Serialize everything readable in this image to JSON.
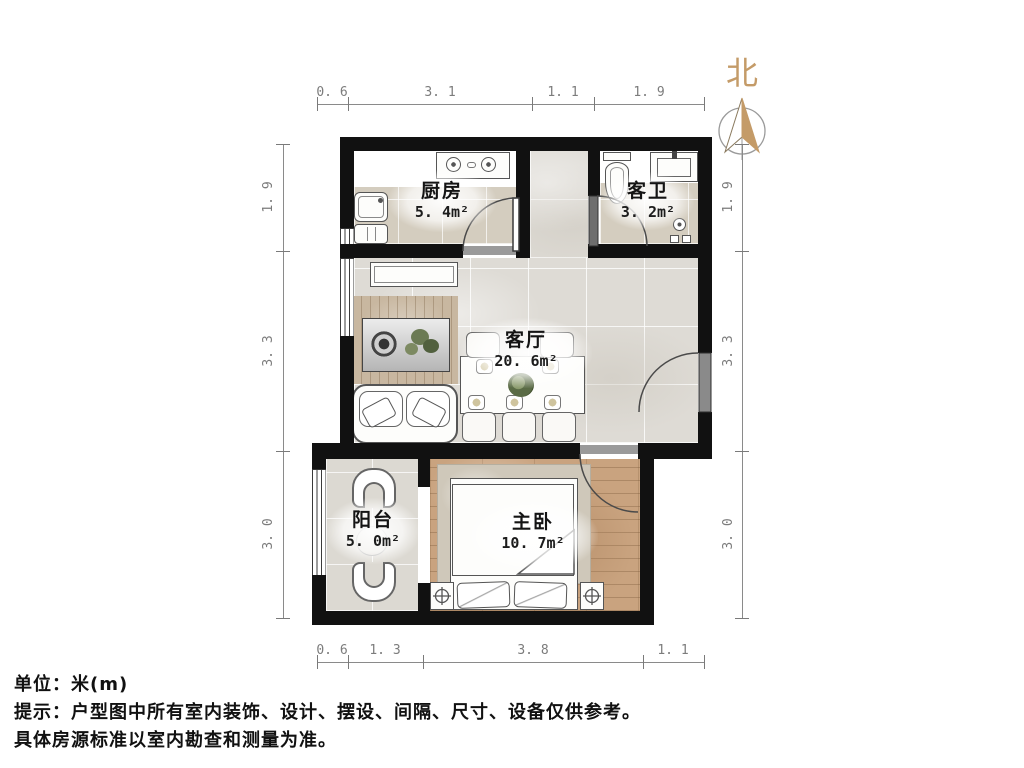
{
  "compass": {
    "label": "北"
  },
  "rooms": {
    "kitchen": {
      "name": "厨房",
      "area": "5. 4m²"
    },
    "bathroom": {
      "name": "客卫",
      "area": "3. 2m²"
    },
    "living": {
      "name": "客厅",
      "area": "20. 6m²"
    },
    "balcony": {
      "name": "阳台",
      "area": "5. 0m²"
    },
    "bedroom": {
      "name": "主卧",
      "area": "10. 7m²"
    }
  },
  "dimensions": {
    "top": [
      "0. 6",
      "3. 1",
      "1. 1",
      "1. 9"
    ],
    "bottom": [
      "0. 6",
      "1. 3",
      "3. 8",
      "1. 1"
    ],
    "left": [
      "1. 9",
      "3. 3",
      "3. 0"
    ],
    "right": [
      "1. 9",
      "3. 3",
      "3. 0"
    ]
  },
  "footer": {
    "unit_line": "单位：米(m)",
    "note_line1": "提示：户型图中所有室内装饰、设计、摆设、间隔、尺寸、设备仅供参考。",
    "note_line2": "具体房源标准以室内勘查和测量为准。"
  },
  "colors": {
    "wall": "#111111",
    "tile_warm": "#d4cdbf",
    "tile_cool": "#dedbd5",
    "wood": "#c9a37f",
    "north_accent": "#c49b68",
    "dimension": "#7c7c7c"
  }
}
